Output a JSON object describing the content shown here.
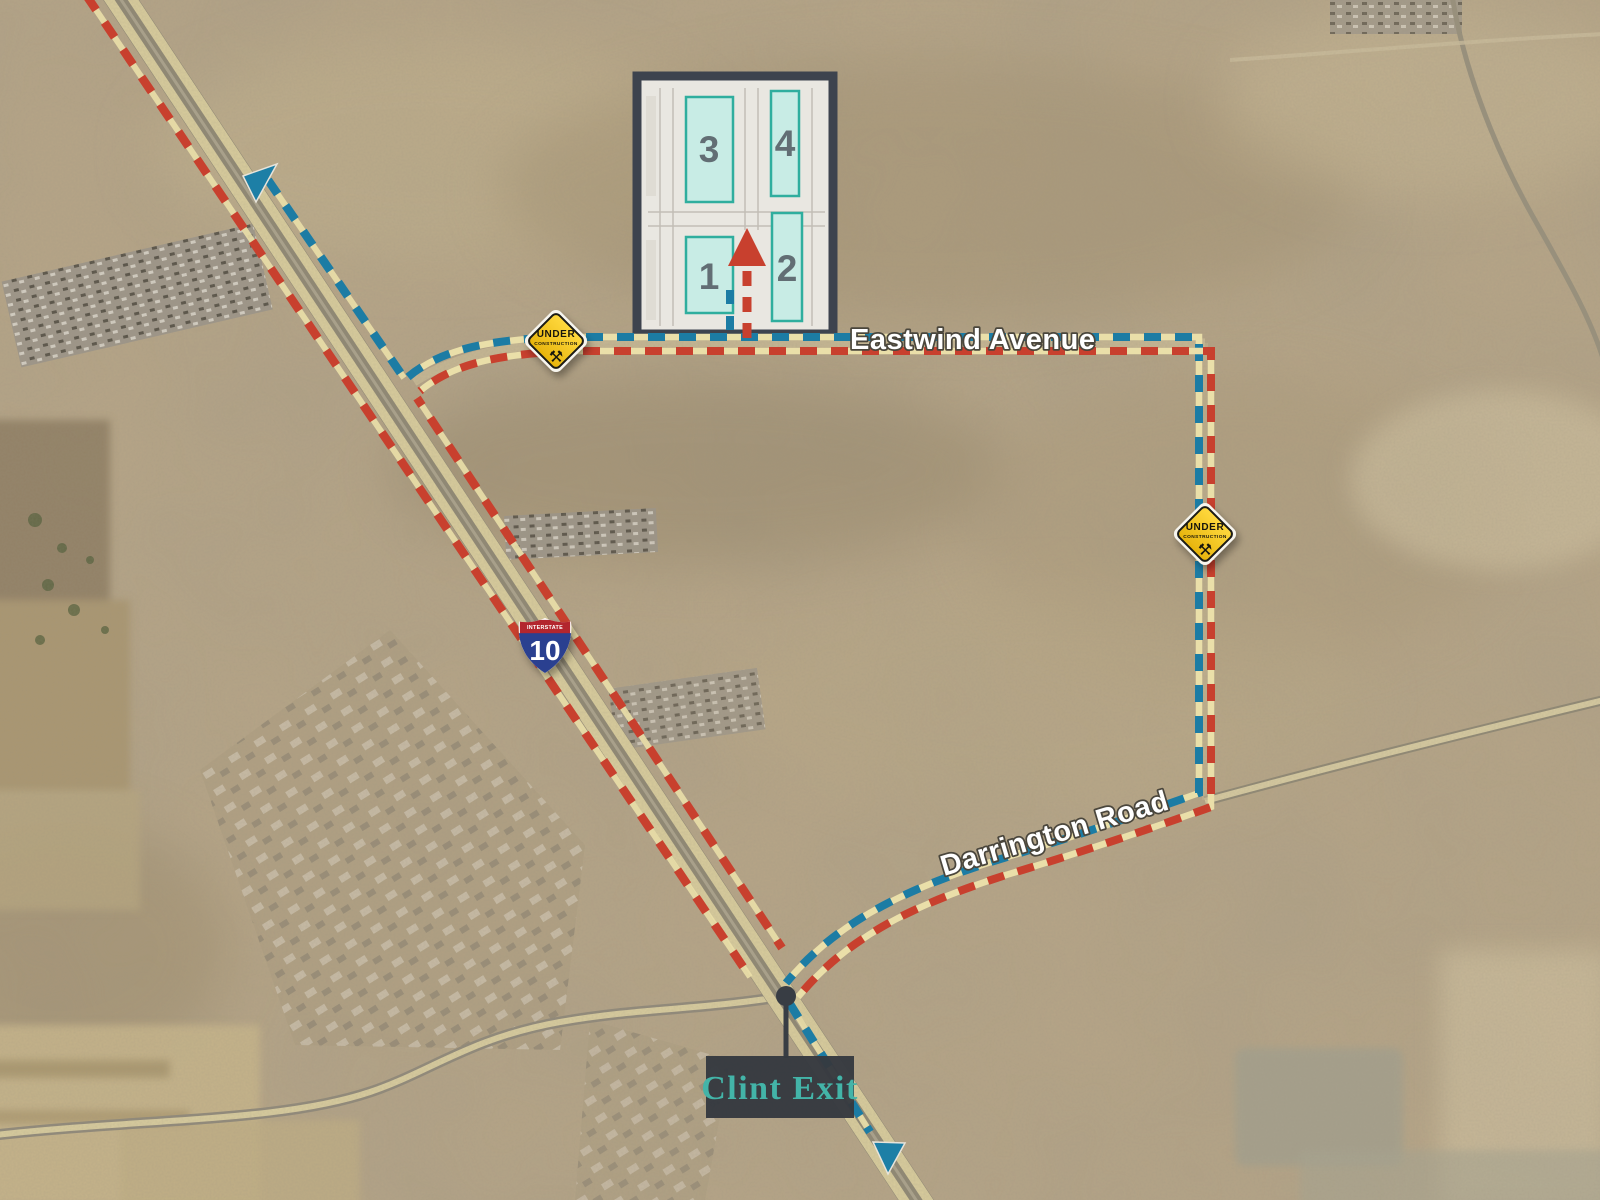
{
  "map_overlay": {
    "road_labels": {
      "eastwind": "Eastwind Avenue",
      "darrington": "Darrington Road"
    },
    "exit_callout": {
      "label": "Clint Exit"
    },
    "interstate_shield": {
      "banner": "INTERSTATE",
      "route_number": "10"
    },
    "construction_signs": [
      {
        "line1": "UNDER",
        "line2": "CONSTRUCTION",
        "icon": "hammer-pick-icon",
        "icon_glyph": "⚒"
      },
      {
        "line1": "UNDER",
        "line2": "CONSTRUCTION",
        "icon": "hammer-pick-icon",
        "icon_glyph": "⚒"
      }
    ],
    "site_plan": {
      "buildings": [
        {
          "number": "1"
        },
        {
          "number": "2"
        },
        {
          "number": "3"
        },
        {
          "number": "4"
        }
      ]
    },
    "legend_colors": {
      "route_red": "#c8402e",
      "route_blue": "#1c7ca4",
      "route_tan": "#eadfa9",
      "accent_teal": "#43b4a8",
      "sign_yellow": "#f2c411",
      "shield_blue": "#2a3f90",
      "shield_red": "#b3282d",
      "building_fill": "#c8ece5",
      "building_stroke": "#2fae9e"
    }
  }
}
